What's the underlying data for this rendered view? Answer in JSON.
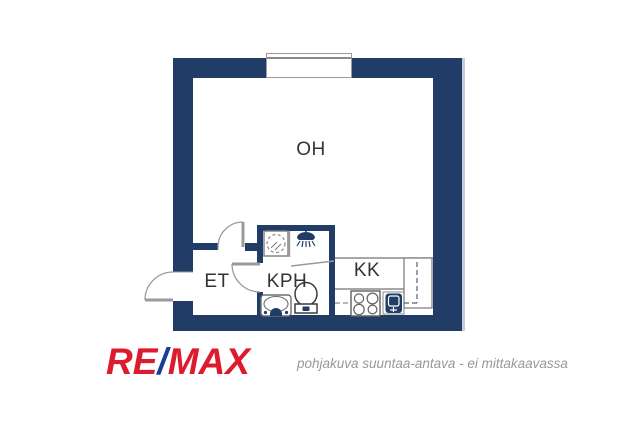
{
  "plan": {
    "rooms": {
      "living": {
        "label": "OH"
      },
      "hall": {
        "label": "ET"
      },
      "bathroom": {
        "label": "KPH"
      },
      "kitchenette": {
        "label": "KK"
      }
    },
    "icons": {
      "window": "double-line-window-in-wall",
      "entrance-door": "quarter-arc-door-opening-outward",
      "interior-door-oh-et": "quarter-arc-door-into-living-room",
      "interior-door-kph": "quarter-arc-door-into-hall",
      "washing-machine": "square-with-dashed-drum-circle",
      "shower-head": "shower-head-with-spray-lines",
      "toilet": "bowl-with-cistern",
      "washbasin": "rounded-basin-with-tap",
      "stove": "square-with-four-burner-circles",
      "kitchen-sink": "dark-rounded-sink-basin",
      "tall-cabinet": "tall-unit-with-dashed-depth-lines"
    }
  },
  "footer": {
    "logo": {
      "re": "RE",
      "slash": "/",
      "max": "MAX"
    },
    "disclaimer": "pohjakuva suuntaa-antava - ei mittakaavassa"
  },
  "colors": {
    "wall_navy": "#213c66",
    "brand_red": "#dc1c2e",
    "brand_blue": "#1a3e94",
    "fixture_gray": "#8a8a8a",
    "label_text": "#333333",
    "disclaimer_gray": "#989898"
  }
}
